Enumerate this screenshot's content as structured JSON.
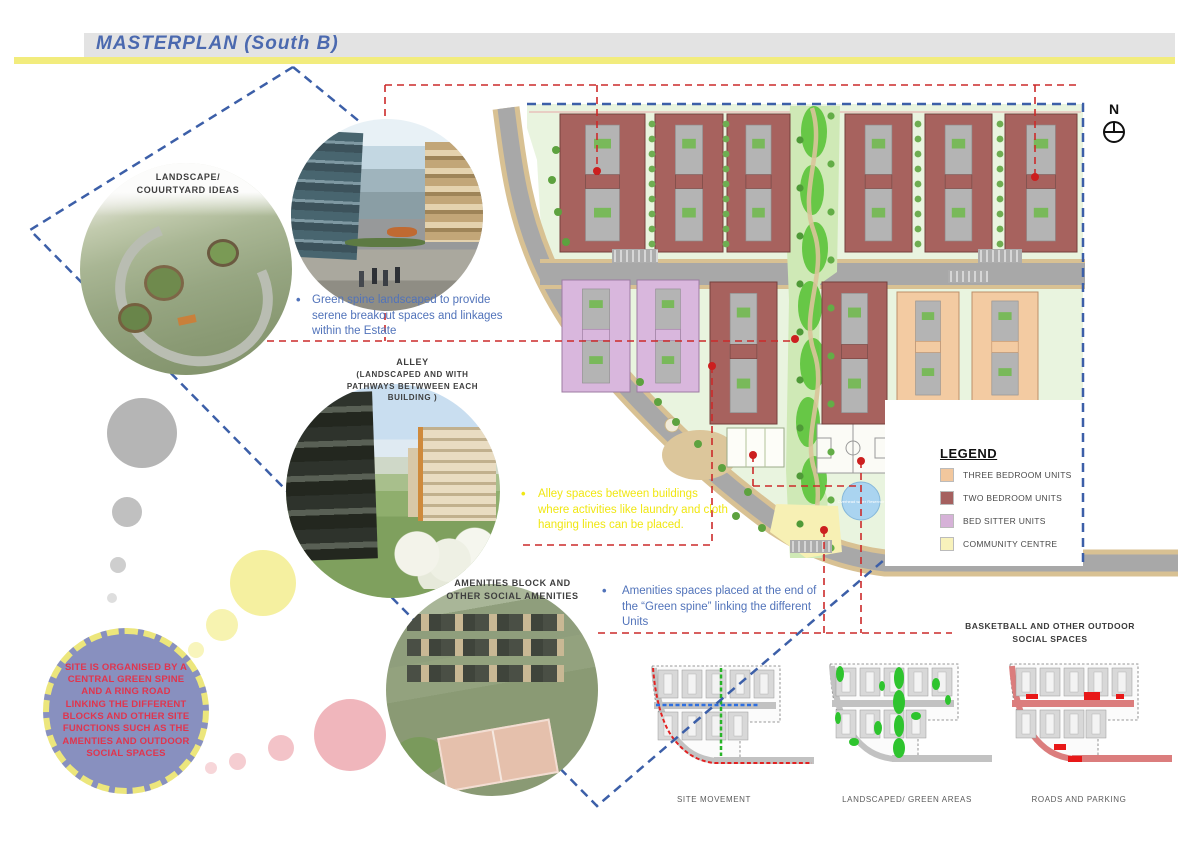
{
  "header": {
    "title": "MASTERPLAN (South B)"
  },
  "north_label": "N",
  "callouts": {
    "landscape_label": "LANDSCAPE/\nCOUURTYARD IDEAS",
    "alley_title": "ALLEY",
    "alley_subtitle": "(LANDSCAPED AND WITH\nPATHWAYS BETWWEEN EACH\nBUILDING )",
    "amenities_label": "AMENITIES BLOCK AND\nOTHER SOCIAL AMENITIES",
    "basketball_label": "BASKETBALL AND OTHER OUTDOOR\nSOCIAL SPACES"
  },
  "notes": {
    "green_spine": "Green spine landscaped to provide serene breakout spaces and linkages within the Estate",
    "alley_spaces": "Alley spaces between buildings where activities like laundry and cloth hanging lines can be placed.",
    "amenities_spaces": "Amenities spaces placed at the end of the “Green spine” linking the different Units",
    "site_organisation": "SITE IS ORGANISED BY A CENTRAL GREEN SPINE AND A RING ROAD LINKING THE DIFFERENT BLOCKS AND OTHER SITE FUNCTIONS SUCH AS THE AMENTIES AND OUTDOOR SOCIAL SPACES"
  },
  "legend": {
    "title": "LEGEND",
    "items": [
      {
        "label": "THREE BEDROOM UNITS",
        "color": "#f2c79d"
      },
      {
        "label": "TWO BEDROOM UNITS",
        "color": "#a5605f"
      },
      {
        "label": "BED SITTER UNITS",
        "color": "#d6b2d8"
      },
      {
        "label": "COMMUNITY CENTRE",
        "color": "#f8f2bb"
      }
    ]
  },
  "plan": {
    "reservoir_label": "Overhead water Reservoir"
  },
  "diagrams": [
    {
      "label": "SITE MOVEMENT"
    },
    {
      "label": "LANDSCAPED/ GREEN AREAS"
    },
    {
      "label": "ROADS AND PARKING"
    }
  ],
  "colors": {
    "accent_yellow": "#f2ec7d",
    "annotation_blue": "#5173ba",
    "annotation_yellow": "#f0e713",
    "annotation_red": "#cc2a2a",
    "boundary_blue": "#3c5fa8"
  }
}
